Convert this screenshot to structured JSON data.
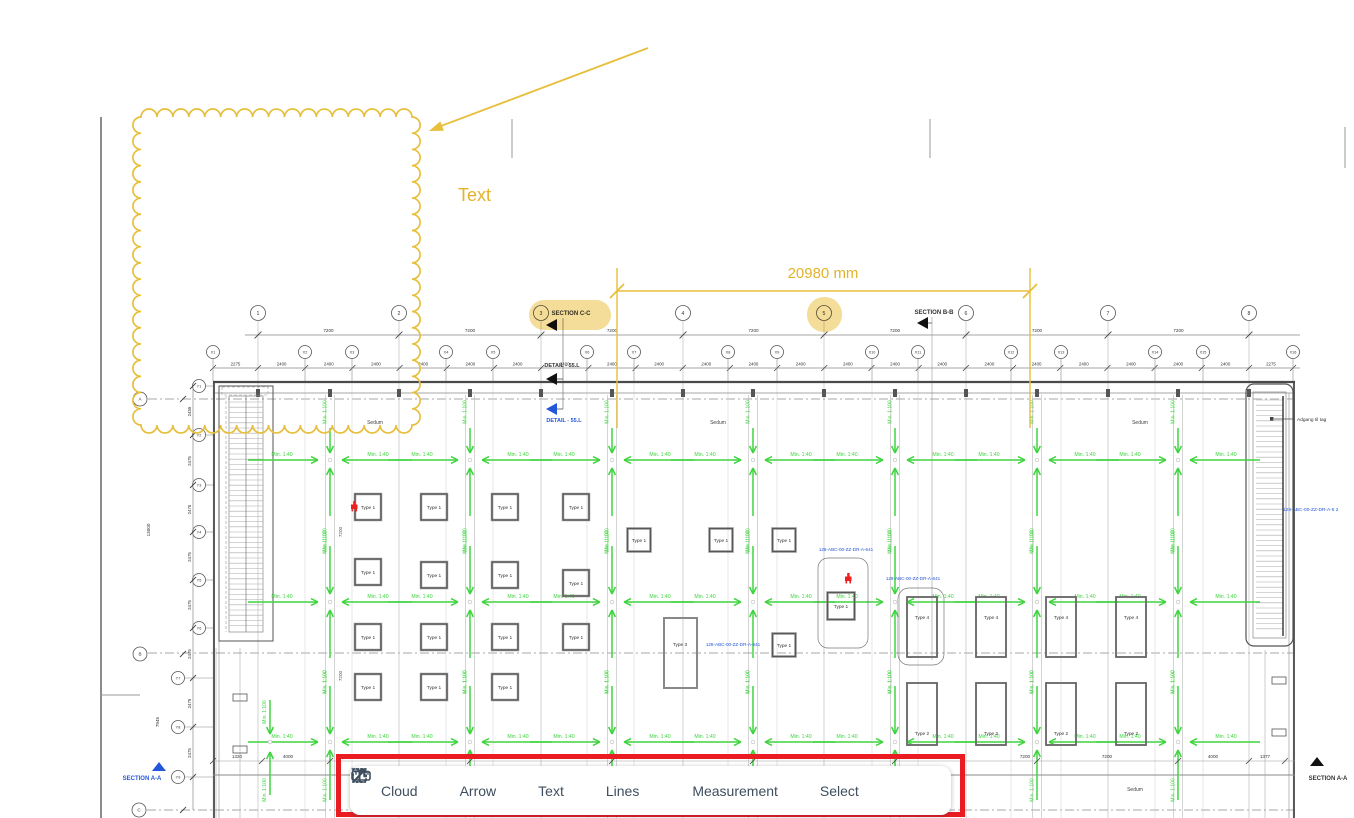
{
  "toolbar": {
    "highlight_color": "#ea1c22",
    "tools": [
      {
        "label": "Cloud",
        "icon": "cloud-icon"
      },
      {
        "label": "Arrow",
        "icon": "arrow-icon"
      },
      {
        "label": "Text",
        "icon": "text-icon"
      },
      {
        "label": "Lines",
        "icon": "lines-icon",
        "dropdown": true
      },
      {
        "label": "Measurement",
        "icon": "measurement-icon"
      },
      {
        "label": "Select",
        "icon": "select-icon"
      }
    ]
  },
  "annotations": {
    "color": "#e8bf3c",
    "text_label": "Text",
    "measurement_label": "20980 mm"
  },
  "plan": {
    "grid_numbers": [
      "1",
      "2",
      "3",
      "4",
      "5",
      "6",
      "7",
      "8"
    ],
    "grid_x": [
      "X1",
      "X2",
      "X3",
      "X4",
      "X5",
      "X6",
      "X7",
      "X8",
      "X9",
      "X10",
      "X11",
      "X12",
      "X13",
      "X14",
      "X15",
      "X16"
    ],
    "grid_y": [
      "Y1",
      "Y2",
      "Y3",
      "Y4",
      "Y5",
      "Y6",
      "Y7",
      "Y8",
      "Y9"
    ],
    "grid_letters": [
      "A",
      "B",
      "C"
    ],
    "dims": {
      "bay": "7200",
      "x_spacing": "2400",
      "x_end": "2275",
      "y_spacing": "2475",
      "y_top": "2455",
      "left_total": "13000",
      "left_lower": "7945",
      "inner_bay": "7200",
      "bottom_left": [
        "1320",
        "4000"
      ],
      "bottom_right": [
        "7200",
        "7200",
        "4000",
        "1377"
      ]
    },
    "slope_labels": {
      "horizontal": "Min. 1:40",
      "vertical": "Min. 1:100"
    },
    "surface_label": "Sedum",
    "types": {
      "t1": "Type 1",
      "t2": "Type 2",
      "t3": "Type 3",
      "t4": "Type 4"
    },
    "sections": {
      "cc": "SECTION C-C",
      "bb": "SECTION B-B",
      "aa": "SECTION A-A",
      "detail": "DETAIL - 55.L"
    },
    "refs": {
      "r641": "128-ABC-00-ZZ-DR-A-641",
      "r52": "128-ABC-00-ZZ-DR-A-5 2",
      "roof_access": "Adgang til tag"
    }
  }
}
